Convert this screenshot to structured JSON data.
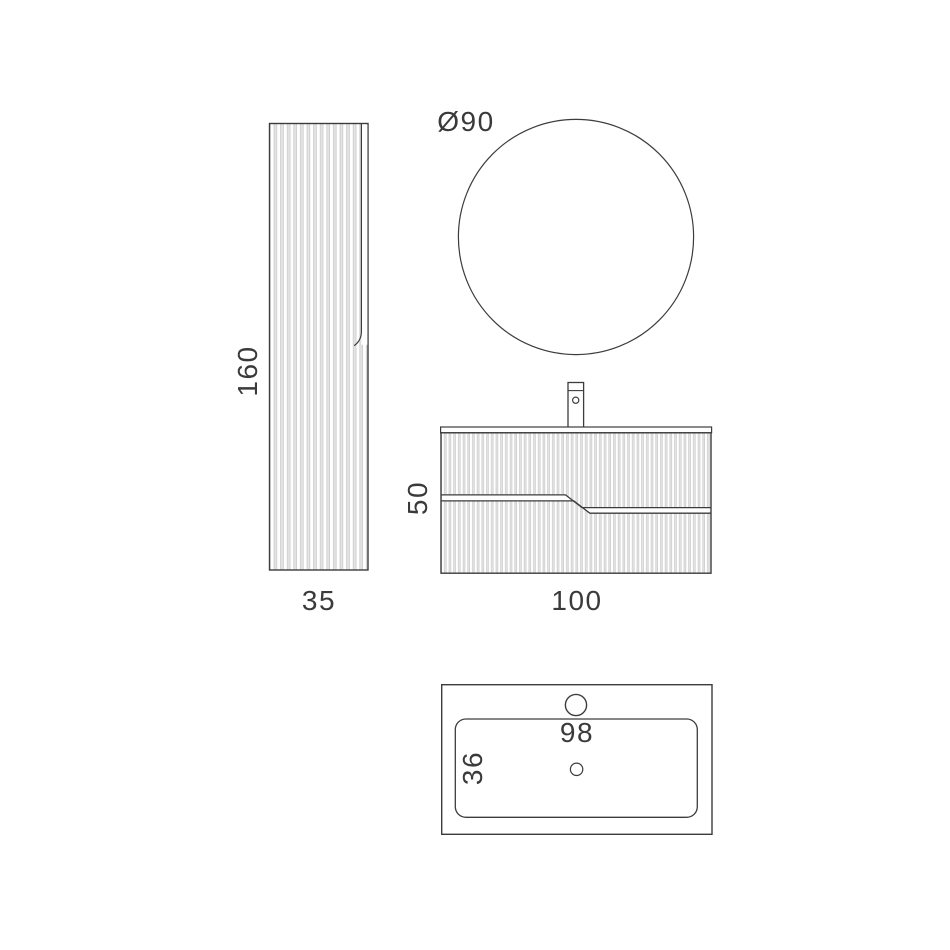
{
  "diagram": {
    "type": "bathroom-furniture-dimension-drawing",
    "background_color": "#ffffff",
    "line_color": "#3c3c3c",
    "text_color": "#3a3a3a",
    "rib_fill_color": "#e3e3e3",
    "rib_edge_color": "#c8c8c8",
    "labels": {
      "cabinet_height": "160",
      "cabinet_width": "35",
      "mirror_diameter": "Ø90",
      "vanity_height": "50",
      "vanity_width": "100",
      "basin_width": "98",
      "basin_depth": "36"
    },
    "components": [
      {
        "id": "tall-side-cabinet",
        "view": "front",
        "height": "160",
        "width": "35",
        "texture": "vertical-fluted"
      },
      {
        "id": "round-mirror",
        "view": "front",
        "diameter": "Ø90"
      },
      {
        "id": "vanity-unit-with-faucet",
        "view": "front",
        "height": "50",
        "width": "100",
        "texture": "vertical-fluted",
        "drawers": 2
      },
      {
        "id": "washbasin",
        "view": "top",
        "width": "98",
        "depth": "36"
      }
    ]
  }
}
